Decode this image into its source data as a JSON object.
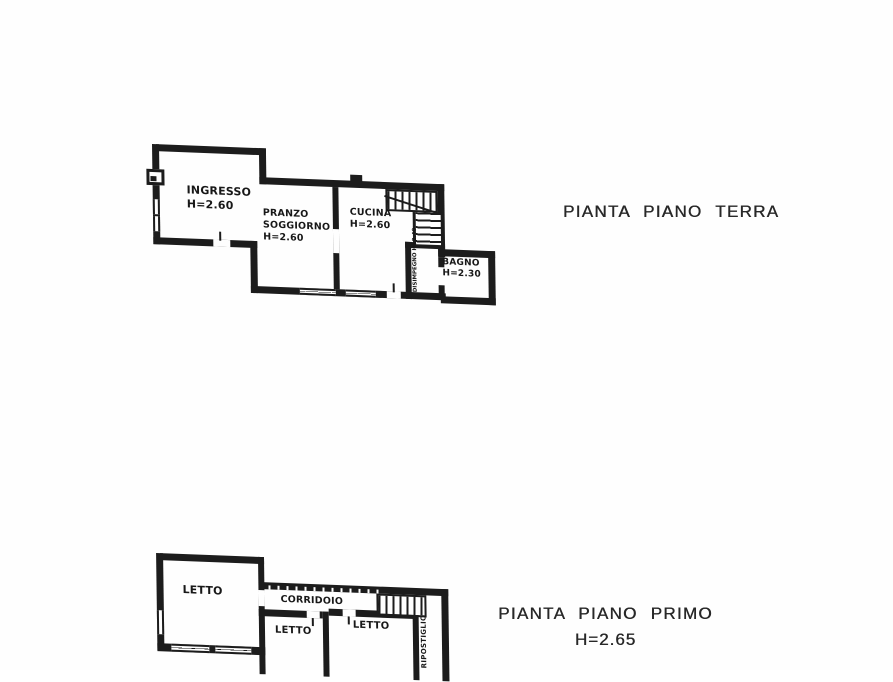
{
  "page": {
    "background": "#fefefe",
    "ink": "#1c1c1c"
  },
  "ground_floor": {
    "title": "PIANTA PIANO TERRA",
    "rooms": {
      "ingresso": {
        "name": "INGRESSO",
        "height": "H=2.60"
      },
      "pranzo": {
        "name_line1": "PRANZO",
        "name_line2": "SOGGIORNO",
        "height": "H=2.60"
      },
      "cucina": {
        "name": "CUCINA",
        "height": "H=2.60"
      },
      "disimpegno": {
        "name": "DISIMPEGNO",
        "height": "H=2.40"
      },
      "bagno": {
        "name": "BAGNO",
        "height": "H=2.30"
      }
    }
  },
  "first_floor": {
    "title": "PIANTA PIANO PRIMO",
    "height": "H=2.65",
    "rooms": {
      "letto1": {
        "name": "LETTO"
      },
      "corridoio": {
        "name": "CORRIDOIO"
      },
      "letto2": {
        "name": "LETTO"
      },
      "letto3": {
        "name": "LETTO"
      },
      "ripostiglio": {
        "name": "RIPOSTIGLIO"
      }
    }
  }
}
